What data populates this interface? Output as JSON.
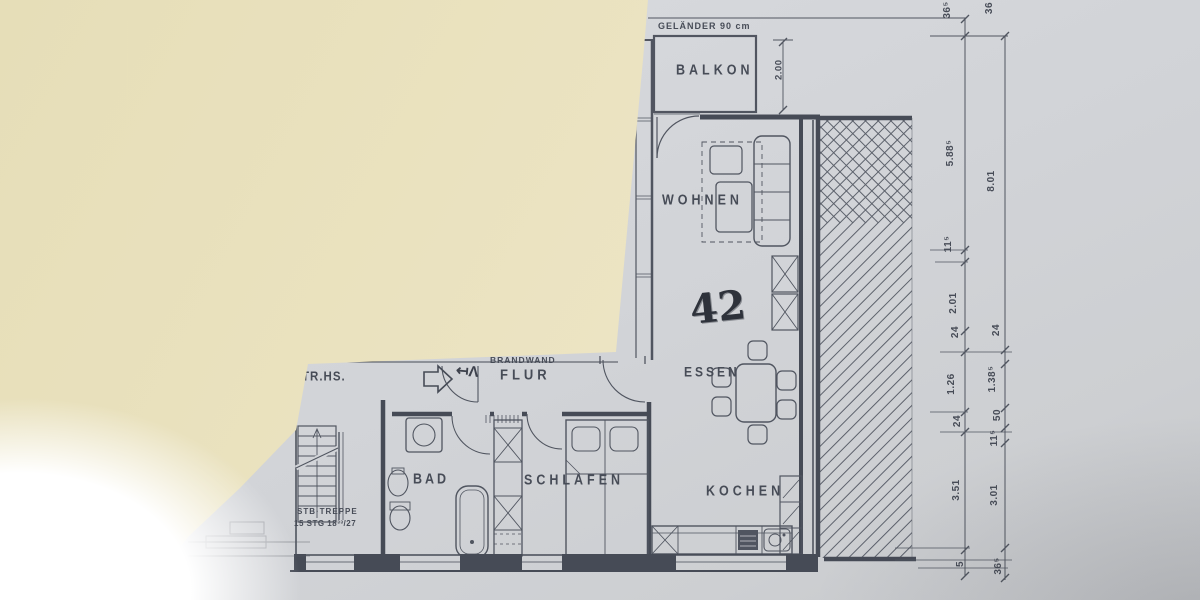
{
  "photo": {
    "description": "Photo of an architectural floor plan, top-left corner covered by an overlapping cream sheet of paper",
    "colors": {
      "plan_paper": "#d3d5d9",
      "overlay_paper": "#eae2bf",
      "ink": "#4a4f5a"
    }
  },
  "plan": {
    "rooms": {
      "balkon": "BALKON",
      "wohnen": "WOHNEN",
      "essen": "ESSEN",
      "kochen": "KOCHEN",
      "schlafen": "SCHLAFEN",
      "bad": "BAD",
      "flur": "FLUR",
      "treppenhaus": "TR.HS."
    },
    "annotations": {
      "gelaender": "GELÄNDER 90 cm",
      "brandwand": "BRANDWAND",
      "apartment_number": "42",
      "treppe_line1": "STB·TREPPE",
      "treppe_line2": "15 STG 18³³/27",
      "balcony_depth": "2.00",
      "handwritten_note": "↤Λ"
    },
    "dimensions": {
      "inner_chain": [
        "36⁵",
        "5.88⁵",
        "11⁵",
        "2.01",
        "24",
        "1.26",
        "24",
        "3.51",
        "5"
      ],
      "outer_chain": [
        "36",
        "8.01",
        "24",
        "1.38⁵",
        "50",
        "11⁵",
        "3.01",
        "36⁵"
      ]
    }
  }
}
